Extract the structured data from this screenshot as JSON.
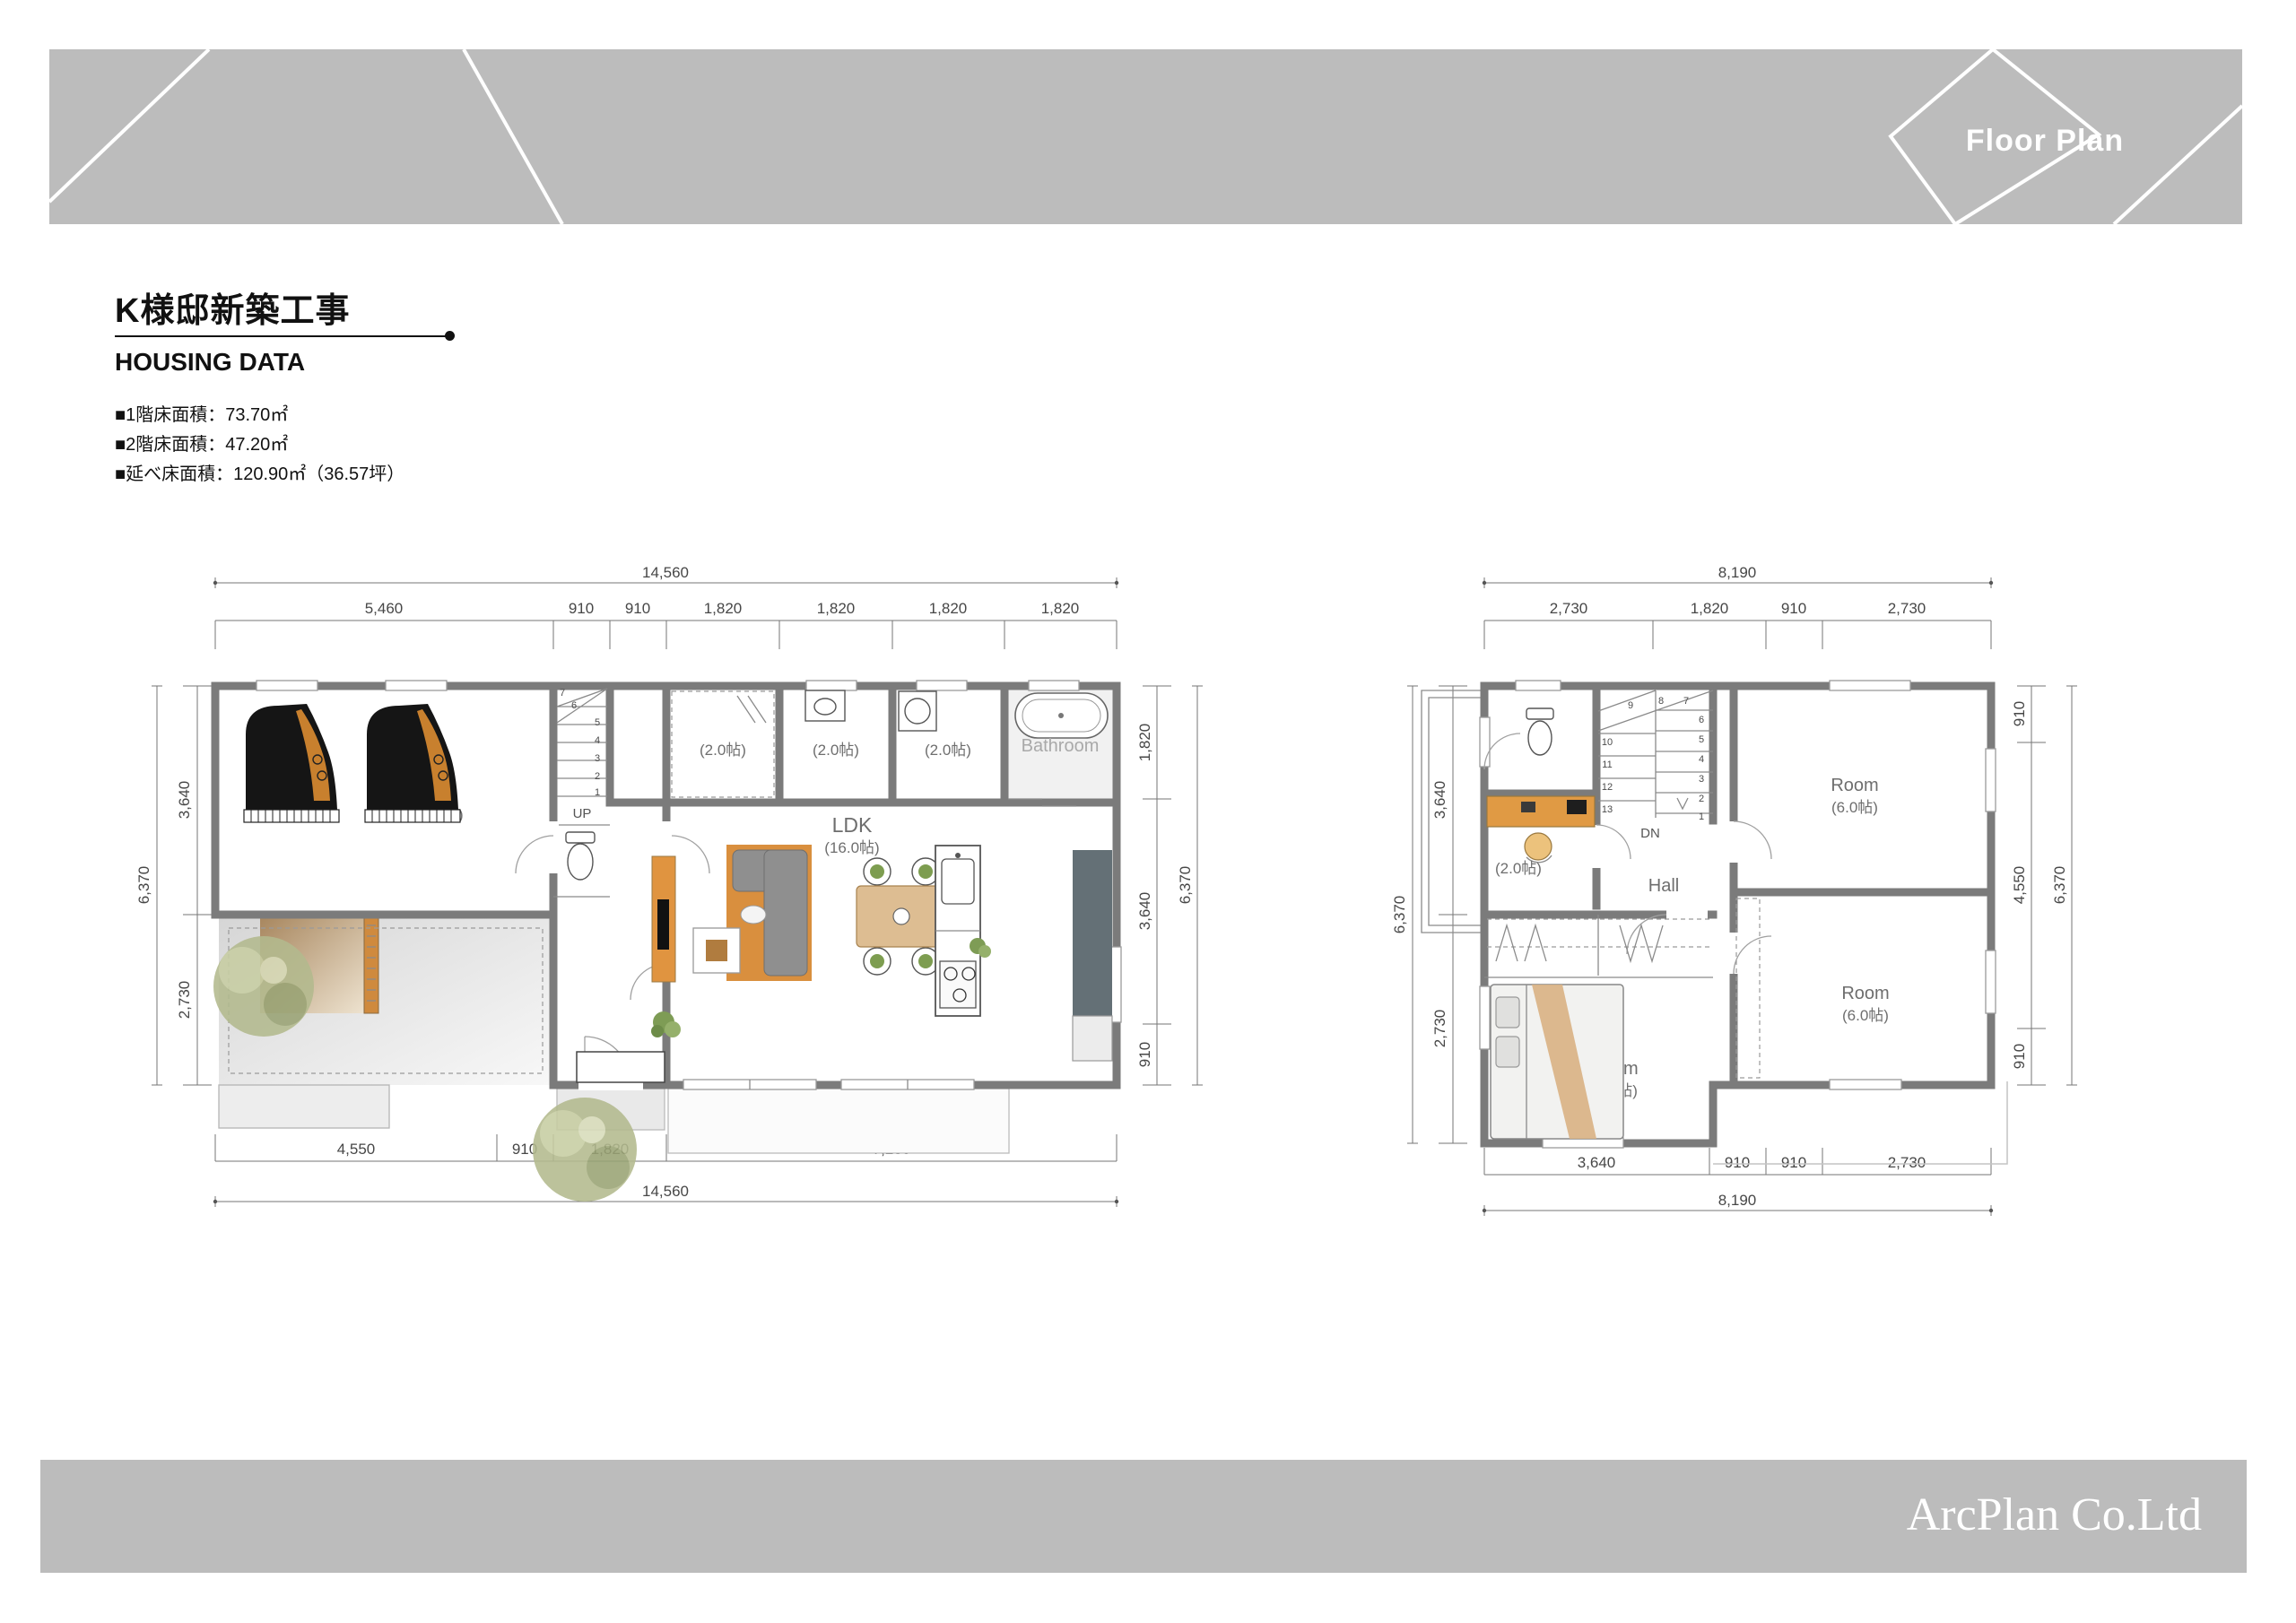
{
  "header": {
    "banner_label": "Floor Plan"
  },
  "title_block": {
    "project_title": "K様邸新築工事",
    "section_title": "HOUSING DATA",
    "specs": [
      "■1階床面積：73.70㎡",
      "■2階床面積：47.20㎡",
      "■延べ床面積：120.90㎡（36.57坪）"
    ]
  },
  "floor1": {
    "dims": {
      "top_total": "14,560",
      "top_segments": [
        "5,460",
        "910",
        "910",
        "1,820",
        "1,820",
        "1,820",
        "1,820"
      ],
      "bottom_segments": [
        "4,550",
        "910",
        "1,820",
        "7,280"
      ],
      "bottom_total": "14,560",
      "left_segments": [
        "3,640",
        "2,730"
      ],
      "left_total": "6,370",
      "right_segments": [
        "1,820",
        "3,640",
        "910"
      ],
      "right_total": "6,370"
    },
    "labels": {
      "piano_room_size": "(12.0帖)",
      "closet_size": "(2.0帖)",
      "washroom_size": "(2.0帖)",
      "utility_size": "(2.0帖)",
      "bathroom": "Bathroom",
      "ldk": "LDK",
      "ldk_size": "(16.0帖)",
      "stairs_up": "UP"
    },
    "stair_numbers": [
      "1",
      "2",
      "3",
      "4",
      "5",
      "6",
      "7"
    ]
  },
  "floor2": {
    "dims": {
      "top_total": "8,190",
      "top_segments": [
        "2,730",
        "1,820",
        "910",
        "2,730"
      ],
      "bottom_segments": [
        "3,640",
        "910",
        "910",
        "2,730"
      ],
      "bottom_total": "8,190",
      "left_segments": [
        "3,640",
        "2,730"
      ],
      "left_total": "6,370",
      "right_segments": [
        "910",
        "4,550",
        "910"
      ],
      "right_total": "6,370"
    },
    "labels": {
      "desk_room_size": "(2.0帖)",
      "hall": "Hall",
      "room_ne": "Room",
      "room_ne_size": "(6.0帖)",
      "room_se": "Room",
      "room_se_size": "(6.0帖)",
      "room_sw": "Room",
      "room_sw_size": "(7.5帖)",
      "stairs_down": "DN"
    },
    "stair_numbers": [
      "1",
      "2",
      "3",
      "4",
      "5",
      "6",
      "7",
      "8",
      "9",
      "10",
      "11",
      "12",
      "13"
    ]
  },
  "footer": {
    "company_name": "ArcPlan Co.Ltd"
  },
  "colors": {
    "banner_gray": "#bcbcbc",
    "wall_gray": "#7b7b7b",
    "wood_accent": "#dd9a40",
    "text_dark": "#111111",
    "dim_text": "#474747"
  }
}
